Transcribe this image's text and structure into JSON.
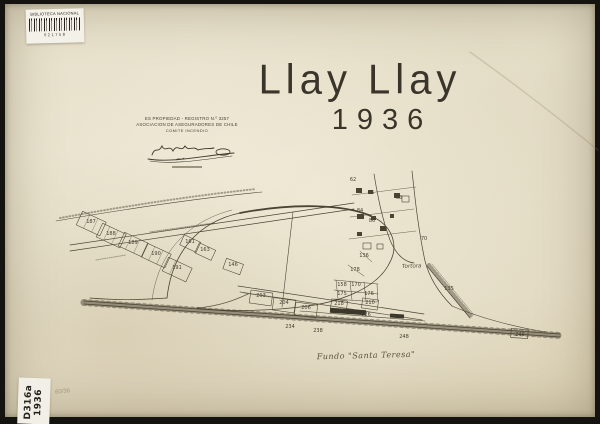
{
  "library_sticker": {
    "title": "BIBLIOTECA NACIONAL",
    "barcode_number": "021758"
  },
  "shelf_sticker": {
    "code": "D316a",
    "year": "1936"
  },
  "title": {
    "name": "Llay Llay",
    "year": "1936"
  },
  "registration_stamp": {
    "line1": "ES PROPIEDAD - REGISTRO N.º 3257",
    "line2": "ASOCIACION DE ASEGURADORES DE CHILE",
    "line3": "COMITE INCENDIO"
  },
  "pencil_note": "60/36",
  "map_caption": "Fundo \"Santa Teresa\"",
  "map": {
    "area_label": "Tortora",
    "parcel_labels": [
      {
        "t": "187",
        "x": 91,
        "y": 223
      },
      {
        "t": "188",
        "x": 111,
        "y": 235
      },
      {
        "t": "189",
        "x": 133,
        "y": 244
      },
      {
        "t": "190",
        "x": 156,
        "y": 255
      },
      {
        "t": "191",
        "x": 177,
        "y": 269
      },
      {
        "t": "161",
        "x": 190,
        "y": 243
      },
      {
        "t": "163",
        "x": 205,
        "y": 251
      },
      {
        "t": "146",
        "x": 233,
        "y": 266
      },
      {
        "t": "203",
        "x": 261,
        "y": 297
      },
      {
        "t": "204",
        "x": 284,
        "y": 304
      },
      {
        "t": "206",
        "x": 306,
        "y": 309
      },
      {
        "t": "218",
        "x": 339,
        "y": 305
      },
      {
        "t": "210",
        "x": 370,
        "y": 304
      },
      {
        "t": "226",
        "x": 366,
        "y": 316
      },
      {
        "t": "234",
        "x": 290,
        "y": 328
      },
      {
        "t": "238",
        "x": 318,
        "y": 332
      },
      {
        "t": "248",
        "x": 404,
        "y": 338
      },
      {
        "t": "246",
        "x": 520,
        "y": 336
      },
      {
        "t": "135",
        "x": 449,
        "y": 290
      },
      {
        "t": "136",
        "x": 364,
        "y": 257
      },
      {
        "t": "178",
        "x": 355,
        "y": 271
      },
      {
        "t": "158",
        "x": 342,
        "y": 286
      },
      {
        "t": "170",
        "x": 356,
        "y": 286
      },
      {
        "t": "175",
        "x": 342,
        "y": 295
      },
      {
        "t": "176",
        "x": 369,
        "y": 295
      },
      {
        "t": "62",
        "x": 353,
        "y": 181
      },
      {
        "t": "66",
        "x": 371,
        "y": 194
      },
      {
        "t": "68",
        "x": 399,
        "y": 199
      },
      {
        "t": "84",
        "x": 360,
        "y": 212
      },
      {
        "t": "86",
        "x": 372,
        "y": 222
      },
      {
        "t": "88",
        "x": 384,
        "y": 231
      },
      {
        "t": "70",
        "x": 424,
        "y": 240
      }
    ]
  }
}
